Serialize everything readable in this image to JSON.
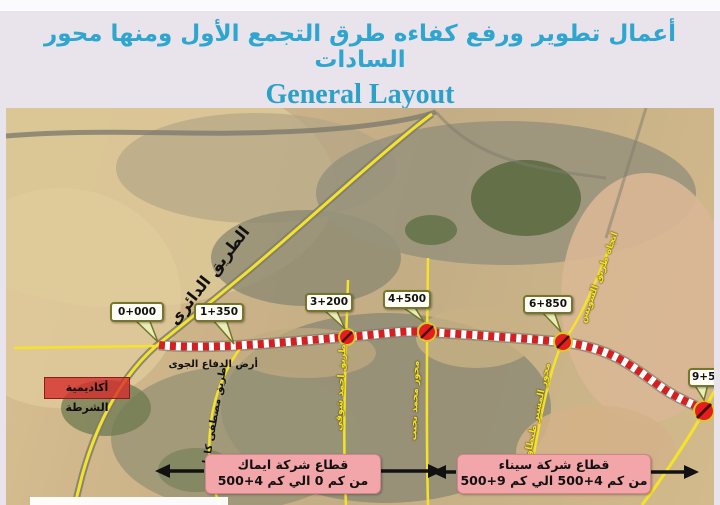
{
  "header": {
    "title_ar": "أعمال تطوير ورفع كفاءه طرق التجمع الأول ومنها محور السادات",
    "title_en": "General Layout"
  },
  "map": {
    "markers": [
      {
        "label": "0+000"
      },
      {
        "label": "1+350"
      },
      {
        "label": "3+200"
      },
      {
        "label": "4+500"
      },
      {
        "label": "6+850"
      },
      {
        "label": "9+500"
      }
    ],
    "labels": {
      "ring_road": "الطريق الدائرى",
      "air_defense": "أرض الدفاع الجوى",
      "police_academy": "أكاديمية الشرطة",
      "mostafa_kamel": "طريق مصطفى كامل",
      "ahmed_shawky": "طريق احمد شوقى",
      "road_4500": "محور محمد نجيب",
      "suez_direction": "اتجاه طريق السويس",
      "tantawy": "محور المشير طنطاوى"
    },
    "sectors": [
      {
        "line1": "قطاع شركة ايماك",
        "line2": "من كم 0 الي كم 4+500"
      },
      {
        "line1": "قطاع شركة سيناء",
        "line2": "من كم 4+500 الي كم 9+500"
      }
    ]
  },
  "colors": {
    "title_teal": "#2ea6cf",
    "route_red": "#d42020",
    "road_yellow": "#f5e32a",
    "sector_pink": "#f3a6aa",
    "callout_border": "#75752b",
    "background_lavender": "#e9e3eb"
  }
}
